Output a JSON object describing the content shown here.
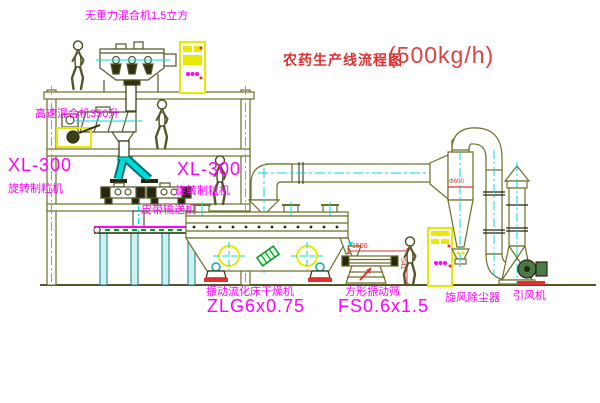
{
  "title": {
    "name": "农药生产线流程图",
    "capacity": "(500kg/h)"
  },
  "labels": {
    "mixer_top": "无重力混合机1.5立方",
    "mixer_mid": "高速混合机350升",
    "granulator_left_model": "XL-300",
    "granulator_left_name": "旋转制粒机",
    "granulator_right_model": "XL-300",
    "granulator_right_name": "旋转制粒机",
    "belt_conveyor": "皮带输送机",
    "dryer_name": "振动流化床干燥机",
    "dryer_model": "ZLG6x0.75",
    "screen_name": "方形振动筛",
    "screen_model": "FS0.6x1.5",
    "cyclone_name": "旋风除尘器",
    "fan_name": "引风机"
  },
  "dimensions": {
    "screen_length": "1500",
    "screen_height": "541",
    "cyclone_diameter": "Φ600"
  },
  "colors": {
    "label_magenta": "#ff00ff",
    "title_red": "#e03030",
    "line_olive": "#6e6e28",
    "centerline_cyan": "#00dcdc",
    "cabinet_yellow": "#e8e800",
    "dimension_red": "#e03030",
    "battery_green": "#00a020",
    "background": "#ffffff"
  }
}
